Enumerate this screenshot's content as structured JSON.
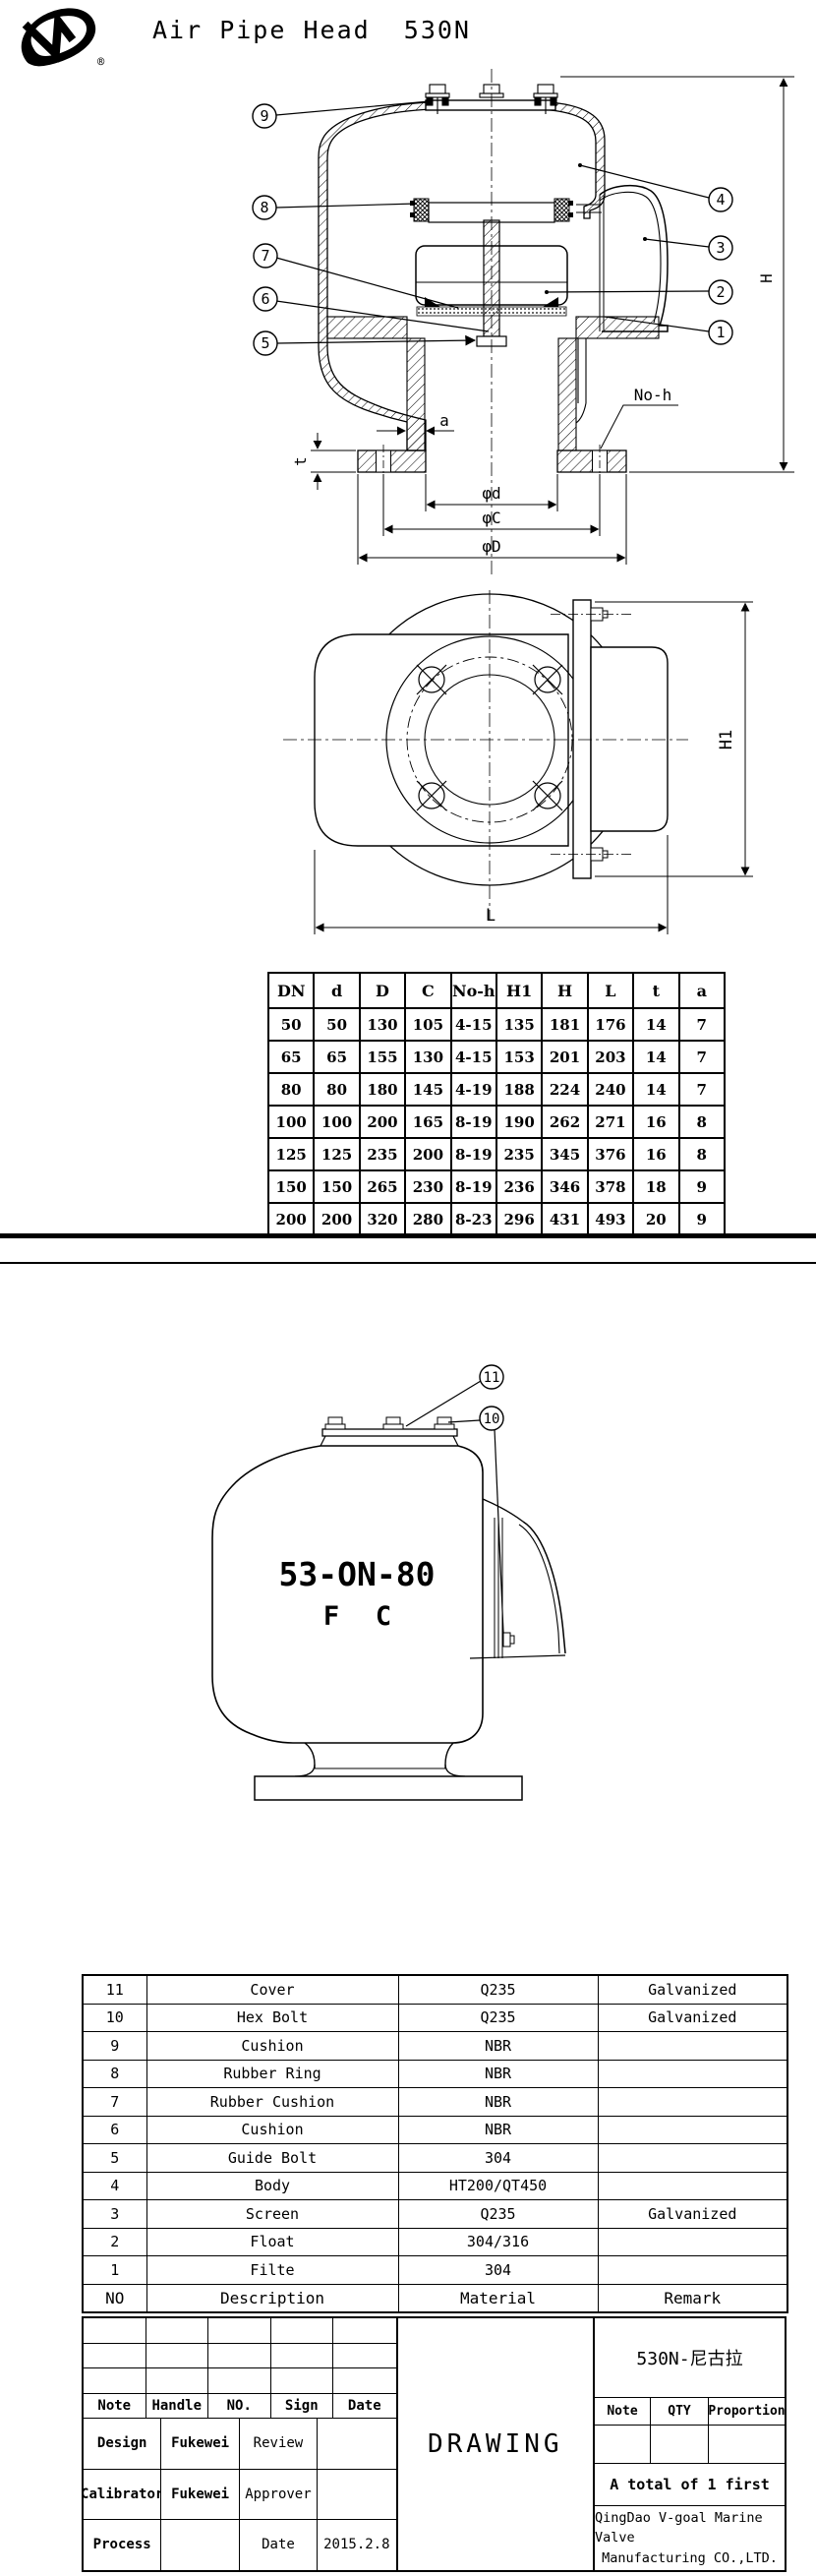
{
  "header": {
    "title": "Air Pipe Head  530N",
    "registered": "®"
  },
  "d1": {
    "callouts": {
      "c1": "1",
      "c2": "2",
      "c3": "3",
      "c4": "4",
      "c5": "5",
      "c6": "6",
      "c7": "7",
      "c8": "8",
      "c9": "9"
    },
    "dims": {
      "a": "a",
      "t": "t",
      "noh": "No-h",
      "pd": "φd",
      "pc": "φC",
      "pD": "φD",
      "H": "H"
    }
  },
  "d2": {
    "dims": {
      "L": "L",
      "H1": "H1"
    }
  },
  "d3": {
    "callouts": {
      "c10": "10",
      "c11": "11"
    },
    "model": "53-ON-80",
    "f": "F",
    "c": "C"
  },
  "dim_table": {
    "headers": [
      "DN",
      "d",
      "D",
      "C",
      "No-h",
      "H1",
      "H",
      "L",
      "t",
      "a"
    ],
    "rows": [
      [
        "50",
        "50",
        "130",
        "105",
        "4-15",
        "135",
        "181",
        "176",
        "14",
        "7"
      ],
      [
        "65",
        "65",
        "155",
        "130",
        "4-15",
        "153",
        "201",
        "203",
        "14",
        "7"
      ],
      [
        "80",
        "80",
        "180",
        "145",
        "4-19",
        "188",
        "224",
        "240",
        "14",
        "7"
      ],
      [
        "100",
        "100",
        "200",
        "165",
        "8-19",
        "190",
        "262",
        "271",
        "16",
        "8"
      ],
      [
        "125",
        "125",
        "235",
        "200",
        "8-19",
        "235",
        "345",
        "376",
        "16",
        "8"
      ],
      [
        "150",
        "150",
        "265",
        "230",
        "8-19",
        "236",
        "346",
        "378",
        "18",
        "9"
      ],
      [
        "200",
        "200",
        "320",
        "280",
        "8-23",
        "296",
        "431",
        "493",
        "20",
        "9"
      ]
    ]
  },
  "parts_table": {
    "headers": [
      "NO",
      "Description",
      "Material",
      "Remark"
    ],
    "rows": [
      [
        "11",
        "Cover",
        "Q235",
        "Galvanized"
      ],
      [
        "10",
        "Hex Bolt",
        "Q235",
        "Galvanized"
      ],
      [
        "9",
        "Cushion",
        "NBR",
        ""
      ],
      [
        "8",
        "Rubber Ring",
        "NBR",
        ""
      ],
      [
        "7",
        "Rubber Cushion",
        "NBR",
        ""
      ],
      [
        "6",
        "Cushion",
        "NBR",
        ""
      ],
      [
        "5",
        "Guide Bolt",
        "304",
        ""
      ],
      [
        "4",
        "Body",
        "HT200/QT450",
        ""
      ],
      [
        "3",
        "Screen",
        "Q235",
        "Galvanized"
      ],
      [
        "2",
        "Float",
        "304/316",
        ""
      ],
      [
        "1",
        "Filte",
        "304",
        ""
      ]
    ]
  },
  "title_block": {
    "note": "Note",
    "handle": "Handle",
    "no": "NO.",
    "sign": "Sign",
    "date": "Date",
    "design": "Design",
    "design_by": "Fukewei",
    "review": "Review",
    "calibrator": "Calibrator",
    "calibrator_by": "Fukewei",
    "approver": "Approver",
    "process": "Process",
    "date_label": "Date",
    "date_value": "2015.2.8",
    "drawing": "DRAWING",
    "model": "530N-尼古拉",
    "note2": "Note",
    "qty": "QTY",
    "proportion": "Proportion",
    "total": "A total of 1 first",
    "company1": "QingDao V-goal Marine Valve",
    "company2": "Manufacturing CO.,LTD."
  }
}
